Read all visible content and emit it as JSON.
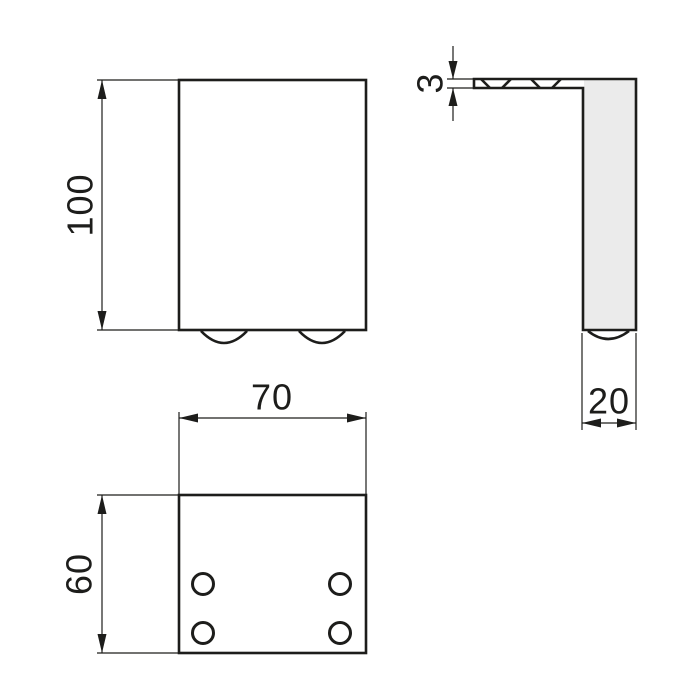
{
  "drawing": {
    "type": "technical-orthographic-views",
    "subject": "L-shaped furniture leg bracket",
    "colors": {
      "part_fill": "#ebebeb",
      "line": "#1d1d1b",
      "background": "#ffffff"
    },
    "views": {
      "front": {
        "label": "front view",
        "dim_height": "100"
      },
      "side": {
        "label": "side view",
        "dim_plate_thickness": "3",
        "dim_leg_depth": "20"
      },
      "bottom": {
        "label": "bottom view",
        "dim_width": "70",
        "dim_depth": "60",
        "hole_count": 4
      }
    }
  }
}
